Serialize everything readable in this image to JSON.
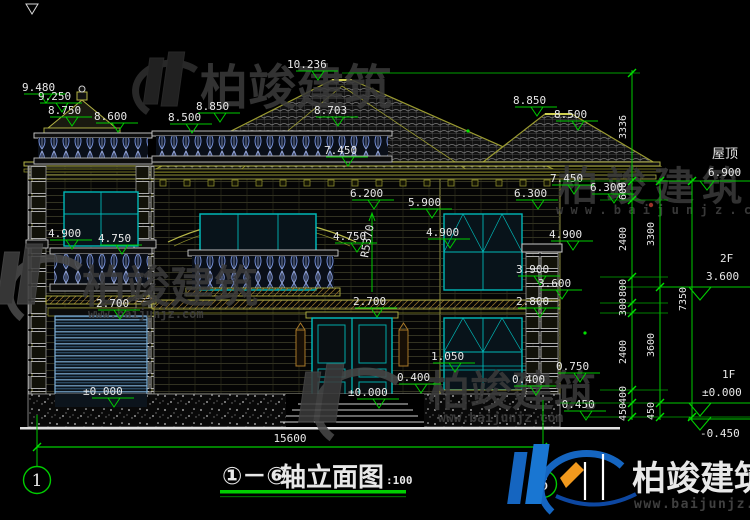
{
  "drawing": {
    "title": {
      "axes_range": "①－⑥",
      "name": "轴立面图",
      "scale": ":100"
    },
    "axis_bubbles": {
      "left": "1",
      "right": "6"
    },
    "total_width_dim": "15600"
  },
  "elevation_labels": {
    "l9480": "9.480",
    "l9250": "9.250",
    "l8750": "8.750",
    "l8600": "8.600",
    "l8500L": "8.500",
    "l8850L": "8.850",
    "ridge": "10.236",
    "l8703": "8.703",
    "l7450C": "7.450",
    "l8850R": "8.850",
    "l8500R": "8.500",
    "l7450R": "7.450",
    "l6300R": "6.300",
    "l6300F": "6.300",
    "l6200": "6.200",
    "l5900": "5.900",
    "arc_radius": "R5370",
    "l4900L": "4.900",
    "l4750L": "4.750",
    "l4750C": "4.750",
    "l4900M": "4.900",
    "l4900R": "4.900",
    "l3900": "3.900",
    "l3600": "3.600",
    "l2800": "2.800",
    "l2700G": "2.700",
    "l2700D": "2.700",
    "l1050": "1.050",
    "l0750": "0.750",
    "l0400A": "0.400",
    "l0400B": "0.400",
    "pm0G": "±0.000",
    "pm0D": "±0.000",
    "m0450A": "-0.450"
  },
  "dim_chains": {
    "a": [
      "3336",
      "600",
      "2400",
      "800",
      "300",
      "2400",
      "400",
      "450"
    ],
    "b": [
      "3300",
      "3600",
      "450"
    ],
    "c": [
      "7350"
    ]
  },
  "floor_levels": {
    "roof": {
      "name": "屋顶",
      "value": "6.900"
    },
    "f2": {
      "name": "2F",
      "value": "3.600"
    },
    "f1": {
      "name": "1F",
      "value": "±0.000"
    },
    "ground": {
      "value": "-0.450"
    }
  },
  "brand": {
    "name": "柏竣建筑",
    "url": "www.baijunjz.com",
    "url_spaced": "w w w . b a i j u n j z . c o m"
  },
  "colors": {
    "dim_green": "#00cc00",
    "building_olive": "#b2b244",
    "window_cyan": "#00b7b7",
    "logo_blue": "#1565c0",
    "logo_orange": "#f2991d"
  }
}
